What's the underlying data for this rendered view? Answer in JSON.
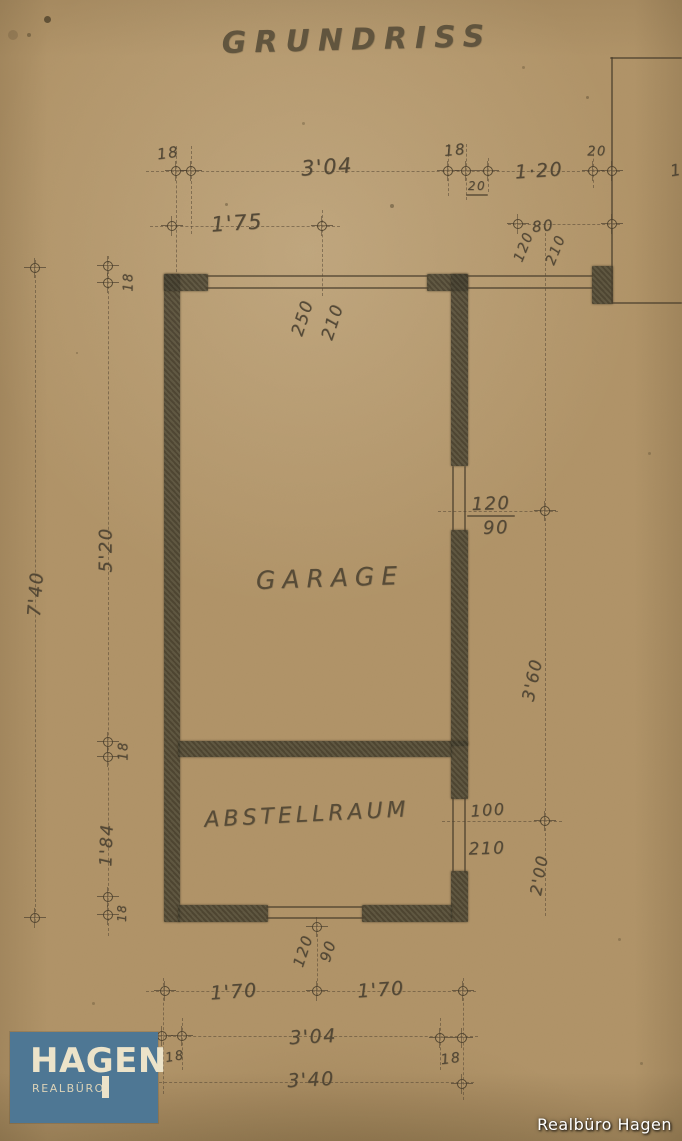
{
  "page": {
    "title": "GRUNDRISS"
  },
  "logo": {
    "name": "HAGEN",
    "subtitle": "REALBÜRO"
  },
  "watermark": "Realbüro Hagen",
  "colors": {
    "paper": "#b19468",
    "pencil": "#4c4232",
    "wall": "#45402e",
    "logo_bg": "#4e7794",
    "logo_text": "#ece3c9"
  },
  "plan": {
    "rooms": [
      {
        "t": "GARAGE",
        "x": 330,
        "y": 578,
        "s": 25,
        "sp": 7,
        "r": -2
      },
      {
        "t": "ABSTELLRAUM",
        "x": 307,
        "y": 815,
        "s": 22,
        "sp": 4,
        "r": -3
      }
    ],
    "labels": [
      {
        "t": "18",
        "x": 168,
        "y": 153,
        "r": -8,
        "s": 15
      },
      {
        "t": "3'04",
        "x": 327,
        "y": 167,
        "r": -4,
        "s": 21
      },
      {
        "t": "1'75",
        "x": 237,
        "y": 223,
        "r": -4,
        "s": 21
      },
      {
        "t": "18",
        "x": 455,
        "y": 150,
        "r": -6,
        "s": 15
      },
      {
        "t": "20",
        "x": 477,
        "y": 186,
        "r": 0,
        "s": 12
      },
      {
        "t": "1·20",
        "x": 539,
        "y": 171,
        "r": -4,
        "s": 19
      },
      {
        "t": "20",
        "x": 597,
        "y": 152,
        "r": 0,
        "s": 13
      },
      {
        "t": "80",
        "x": 543,
        "y": 226,
        "r": -6,
        "s": 15
      },
      {
        "t": "120",
        "x": 524,
        "y": 247,
        "r": -68,
        "s": 14
      },
      {
        "t": "210",
        "x": 556,
        "y": 250,
        "r": -68,
        "s": 14
      },
      {
        "t": "18",
        "x": 129,
        "y": 282,
        "r": -90,
        "s": 13
      },
      {
        "t": "250",
        "x": 303,
        "y": 318,
        "r": -72,
        "s": 17
      },
      {
        "t": "210",
        "x": 333,
        "y": 322,
        "r": -72,
        "s": 17
      },
      {
        "t": "120",
        "x": 491,
        "y": 504,
        "r": -2,
        "s": 18
      },
      {
        "t": "90",
        "x": 496,
        "y": 528,
        "r": -2,
        "s": 18
      },
      {
        "t": "5'20",
        "x": 106,
        "y": 550,
        "r": -90,
        "s": 18
      },
      {
        "t": "7'40",
        "x": 36,
        "y": 594,
        "r": -86,
        "s": 18
      },
      {
        "t": "3'60",
        "x": 533,
        "y": 680,
        "r": -78,
        "s": 17
      },
      {
        "t": "18",
        "x": 124,
        "y": 751,
        "r": -90,
        "s": 13
      },
      {
        "t": "1'84",
        "x": 107,
        "y": 845,
        "r": -88,
        "s": 17
      },
      {
        "t": "100",
        "x": 488,
        "y": 810,
        "r": -4,
        "s": 16
      },
      {
        "t": "210",
        "x": 487,
        "y": 849,
        "r": -2,
        "s": 17
      },
      {
        "t": "2'00",
        "x": 539,
        "y": 875,
        "r": -80,
        "s": 16
      },
      {
        "t": "18",
        "x": 122,
        "y": 913,
        "r": -90,
        "s": 12
      },
      {
        "t": "120",
        "x": 303,
        "y": 951,
        "r": -72,
        "s": 15
      },
      {
        "t": "90",
        "x": 328,
        "y": 951,
        "r": -72,
        "s": 15
      },
      {
        "t": "1'70",
        "x": 234,
        "y": 992,
        "r": -4,
        "s": 19
      },
      {
        "t": "1'70",
        "x": 381,
        "y": 990,
        "r": -4,
        "s": 19
      },
      {
        "t": "3'04",
        "x": 313,
        "y": 1037,
        "r": -3,
        "s": 19
      },
      {
        "t": "18",
        "x": 175,
        "y": 1057,
        "r": -10,
        "s": 13
      },
      {
        "t": "18",
        "x": 451,
        "y": 1059,
        "r": -8,
        "s": 14
      },
      {
        "t": "3'40",
        "x": 311,
        "y": 1080,
        "r": -3,
        "s": 19
      },
      {
        "t": "1",
        "x": 676,
        "y": 170,
        "r": -10,
        "s": 16
      }
    ],
    "walls": [
      [
        164,
        274,
        16,
        648
      ],
      [
        164,
        274,
        44,
        17
      ],
      [
        427,
        274,
        41,
        17
      ],
      [
        451,
        274,
        17,
        192
      ],
      [
        451,
        530,
        17,
        216
      ],
      [
        178,
        741,
        274,
        16
      ],
      [
        451,
        741,
        17,
        58
      ],
      [
        451,
        871,
        17,
        51
      ],
      [
        178,
        905,
        90,
        17
      ],
      [
        362,
        905,
        90,
        17
      ],
      [
        592,
        266,
        21,
        38
      ]
    ],
    "lines": [
      [
        206,
        275,
        223,
        2
      ],
      [
        206,
        287,
        223,
        2
      ],
      [
        467,
        275,
        126,
        2
      ],
      [
        467,
        287,
        126,
        2
      ],
      [
        452,
        466,
        2,
        66
      ],
      [
        464,
        466,
        2,
        66
      ],
      [
        452,
        797,
        2,
        76
      ],
      [
        464,
        797,
        2,
        76
      ],
      [
        266,
        906,
        98,
        2
      ],
      [
        266,
        917,
        98,
        2
      ],
      [
        612,
        302,
        70,
        2
      ],
      [
        610,
        57,
        72,
        2
      ],
      [
        611,
        57,
        2,
        247
      ],
      [
        466,
        194,
        22,
        2
      ],
      [
        467,
        515,
        48,
        2
      ]
    ],
    "dashed": [
      [
        "h",
        146,
        171,
        474
      ],
      [
        "h",
        150,
        226,
        190
      ],
      [
        "h",
        508,
        224,
        112
      ],
      [
        "v",
        35,
        260,
        662
      ],
      [
        "v",
        108,
        256,
        680
      ],
      [
        "v",
        176,
        146,
        136
      ],
      [
        "v",
        191,
        146,
        88
      ],
      [
        "v",
        322,
        210,
        86
      ],
      [
        "v",
        448,
        144,
        52
      ],
      [
        "v",
        466,
        144,
        56
      ],
      [
        "v",
        488,
        158,
        34
      ],
      [
        "v",
        593,
        148,
        40
      ],
      [
        "v",
        545,
        228,
        688
      ],
      [
        "h",
        438,
        511,
        120
      ],
      [
        "h",
        442,
        821,
        120
      ],
      [
        "v",
        317,
        924,
        72
      ],
      [
        "h",
        146,
        991,
        330
      ],
      [
        "h",
        158,
        1036,
        320
      ],
      [
        "h",
        154,
        1082,
        320
      ],
      [
        "v",
        163,
        978,
        116
      ],
      [
        "v",
        182,
        1018,
        52
      ],
      [
        "v",
        440,
        1018,
        52
      ],
      [
        "v",
        463,
        978,
        122
      ]
    ],
    "ticks": [
      [
        176,
        171
      ],
      [
        191,
        171
      ],
      [
        448,
        171
      ],
      [
        466,
        171
      ],
      [
        488,
        171
      ],
      [
        593,
        171
      ],
      [
        612,
        171
      ],
      [
        172,
        226
      ],
      [
        322,
        226
      ],
      [
        518,
        224
      ],
      [
        612,
        224
      ],
      [
        35,
        268
      ],
      [
        108,
        266
      ],
      [
        108,
        283
      ],
      [
        545,
        511
      ],
      [
        108,
        742
      ],
      [
        108,
        757
      ],
      [
        545,
        821
      ],
      [
        108,
        897
      ],
      [
        108,
        915
      ],
      [
        35,
        918
      ],
      [
        317,
        927
      ],
      [
        165,
        991
      ],
      [
        317,
        991
      ],
      [
        463,
        991
      ],
      [
        162,
        1036
      ],
      [
        182,
        1036
      ],
      [
        440,
        1038
      ],
      [
        462,
        1038
      ],
      [
        462,
        1084
      ]
    ],
    "specks": [
      [
        44,
        16,
        7,
        0.75
      ],
      [
        27,
        33,
        4,
        0.45
      ],
      [
        390,
        204,
        4,
        0.45
      ],
      [
        586,
        96,
        3,
        0.4
      ],
      [
        302,
        122,
        3,
        0.3
      ],
      [
        648,
        452,
        3,
        0.3
      ],
      [
        92,
        1002,
        3,
        0.3
      ],
      [
        522,
        66,
        3,
        0.3
      ],
      [
        358,
        744,
        2,
        0.4
      ],
      [
        618,
        938,
        3,
        0.3
      ],
      [
        76,
        352,
        2,
        0.35
      ],
      [
        640,
        1062,
        3,
        0.3
      ],
      [
        8,
        30,
        10,
        0.2
      ],
      [
        225,
        203,
        3,
        0.4
      ]
    ]
  }
}
